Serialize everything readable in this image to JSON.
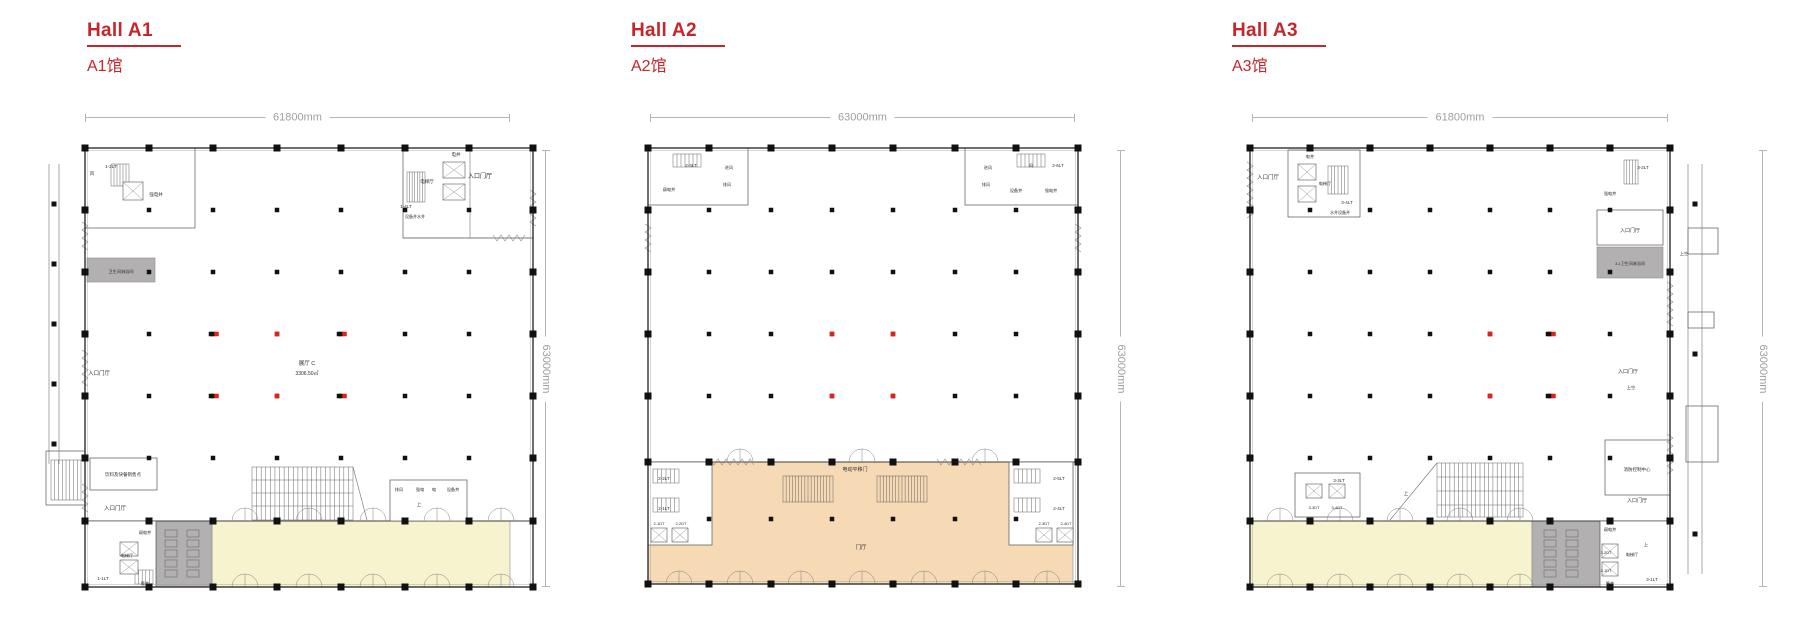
{
  "colors": {
    "accent": "#c4262c",
    "dim_line": "#b5b5b5",
    "dim_text": "#9e9e9e",
    "wall": "#3d3d3d",
    "line": "#6e6e6e",
    "column": "#111111",
    "red_column": "#e32119",
    "zone_yellow": "#f7f3cf",
    "zone_peach": "#f6d9b5",
    "zone_gray": "#b2b0b0"
  },
  "halls": [
    {
      "title": "Hall A1",
      "subtitle": "A1馆",
      "width_label": "61800mm",
      "height_label": "63000mm",
      "plan_labels": [
        {
          "t": "电井",
          "x": 441,
          "y": 142,
          "s": 4.5
        },
        {
          "t": "1-2LT",
          "x": 96,
          "y": 154,
          "s": 4.5
        },
        {
          "t": "风",
          "x": 77,
          "y": 161,
          "s": 4.5
        },
        {
          "t": "电梯厅",
          "x": 412,
          "y": 169,
          "s": 4.5
        },
        {
          "t": "强电井",
          "x": 141,
          "y": 182,
          "s": 4.5
        },
        {
          "t": "入口门厅",
          "x": 465,
          "y": 164,
          "s": 6
        },
        {
          "t": "1-4LT",
          "x": 391,
          "y": 194,
          "s": 4.5
        },
        {
          "t": "设备井水井",
          "x": 400,
          "y": 204,
          "s": 4
        },
        {
          "t": "卫生间淋浴间",
          "x": 106,
          "y": 259,
          "s": 4.2
        },
        {
          "t": "入口门厅",
          "x": 84,
          "y": 361,
          "s": 5.5
        },
        {
          "t": "展厅 C",
          "x": 292,
          "y": 351,
          "s": 5.5
        },
        {
          "t": "3306.50㎡",
          "x": 292,
          "y": 361,
          "s": 5
        },
        {
          "t": "饮料及快餐销售点",
          "x": 108,
          "y": 462,
          "s": 4.5
        },
        {
          "t": "入口门厅",
          "x": 100,
          "y": 496,
          "s": 5.5
        },
        {
          "t": "排风",
          "x": 384,
          "y": 477,
          "s": 4.2
        },
        {
          "t": "强电",
          "x": 405,
          "y": 477,
          "s": 4.2
        },
        {
          "t": "电",
          "x": 419,
          "y": 477,
          "s": 4.2
        },
        {
          "t": "设备井",
          "x": 438,
          "y": 477,
          "s": 4.2
        },
        {
          "t": "上",
          "x": 404,
          "y": 492,
          "s": 4.5
        },
        {
          "t": "弱电井",
          "x": 130,
          "y": 520,
          "s": 4.2
        },
        {
          "t": "电梯厅",
          "x": 112,
          "y": 543,
          "s": 4.2
        },
        {
          "t": "1-1LT",
          "x": 88,
          "y": 566,
          "s": 4.5
        },
        {
          "t": "管井",
          "x": 130,
          "y": 571,
          "s": 4.2
        }
      ]
    },
    {
      "title": "Hall A2",
      "subtitle": "A2馆",
      "width_label": "63000mm",
      "height_label": "63000mm",
      "plan_labels": [
        {
          "t": "2-3LT",
          "x": 76,
          "y": 153,
          "s": 4.5
        },
        {
          "t": "进风",
          "x": 114,
          "y": 155,
          "s": 4.2
        },
        {
          "t": "排风",
          "x": 112,
          "y": 172,
          "s": 4.2
        },
        {
          "t": "弱电井",
          "x": 54,
          "y": 177,
          "s": 4.2
        },
        {
          "t": "风",
          "x": 416,
          "y": 153,
          "s": 4.2
        },
        {
          "t": "2-6LT",
          "x": 443,
          "y": 153,
          "s": 4.5
        },
        {
          "t": "进风",
          "x": 373,
          "y": 155,
          "s": 4.2
        },
        {
          "t": "排风",
          "x": 371,
          "y": 172,
          "s": 4.2
        },
        {
          "t": "设备井",
          "x": 401,
          "y": 178,
          "s": 4.2
        },
        {
          "t": "强电井",
          "x": 436,
          "y": 178,
          "s": 4.2
        },
        {
          "t": "电动平移门",
          "x": 240,
          "y": 457,
          "s": 5
        },
        {
          "t": "门厅",
          "x": 246,
          "y": 535,
          "s": 5.5
        },
        {
          "t": "2-2LT",
          "x": 49,
          "y": 466,
          "s": 4.5
        },
        {
          "t": "2-1LT",
          "x": 49,
          "y": 496,
          "s": 4.5
        },
        {
          "t": "2-1DT",
          "x": 44,
          "y": 511,
          "s": 4
        },
        {
          "t": "2-2DT",
          "x": 66,
          "y": 511,
          "s": 4
        },
        {
          "t": "2-5LT",
          "x": 444,
          "y": 466,
          "s": 4.5
        },
        {
          "t": "2-4LT",
          "x": 444,
          "y": 496,
          "s": 4.5
        },
        {
          "t": "2-3DT",
          "x": 429,
          "y": 511,
          "s": 4
        },
        {
          "t": "2-4DT",
          "x": 451,
          "y": 511,
          "s": 4
        }
      ]
    },
    {
      "title": "Hall A3",
      "subtitle": "A3馆",
      "width_label": "61800mm",
      "height_label": "63000mm",
      "plan_labels": [
        {
          "t": "入口门厅",
          "x": 68,
          "y": 165,
          "s": 5.5
        },
        {
          "t": "电井",
          "x": 110,
          "y": 144,
          "s": 4.2
        },
        {
          "t": "电梯厅",
          "x": 125,
          "y": 171,
          "s": 4.2
        },
        {
          "t": "3-4LT",
          "x": 147,
          "y": 190,
          "s": 4.5
        },
        {
          "t": "水井设备井",
          "x": 140,
          "y": 200,
          "s": 4
        },
        {
          "t": "3-2LT",
          "x": 443,
          "y": 155,
          "s": 4.5
        },
        {
          "t": "强电井",
          "x": 410,
          "y": 181,
          "s": 4.2
        },
        {
          "t": "入口门厅",
          "x": 430,
          "y": 218,
          "s": 5
        },
        {
          "t": "3-1卫生间淋浴间",
          "x": 430,
          "y": 251,
          "s": 4
        },
        {
          "t": "上空",
          "x": 484,
          "y": 241,
          "s": 4.2
        },
        {
          "t": "入口门厅",
          "x": 428,
          "y": 359,
          "s": 5
        },
        {
          "t": "上空",
          "x": 431,
          "y": 375,
          "s": 4.2
        },
        {
          "t": "消防控制中心",
          "x": 437,
          "y": 457,
          "s": 4.5
        },
        {
          "t": "入口门厅",
          "x": 437,
          "y": 488,
          "s": 5
        },
        {
          "t": "上",
          "x": 206,
          "y": 481,
          "s": 4.5
        },
        {
          "t": "3-3LT",
          "x": 139,
          "y": 468,
          "s": 4.5
        },
        {
          "t": "3-3DT",
          "x": 114,
          "y": 495,
          "s": 4
        },
        {
          "t": "3-4DT",
          "x": 137,
          "y": 495,
          "s": 4
        },
        {
          "t": "弱电井",
          "x": 410,
          "y": 517,
          "s": 4.2
        },
        {
          "t": "3-2DT",
          "x": 406,
          "y": 540,
          "s": 4
        },
        {
          "t": "电梯厅",
          "x": 432,
          "y": 542,
          "s": 4.2
        },
        {
          "t": "3-1DT",
          "x": 406,
          "y": 558,
          "s": 4
        },
        {
          "t": "管井",
          "x": 410,
          "y": 571,
          "s": 4.2
        },
        {
          "t": "3-1LT",
          "x": 452,
          "y": 567,
          "s": 4.5
        },
        {
          "t": "上",
          "x": 446,
          "y": 532,
          "s": 4.2
        }
      ]
    }
  ]
}
